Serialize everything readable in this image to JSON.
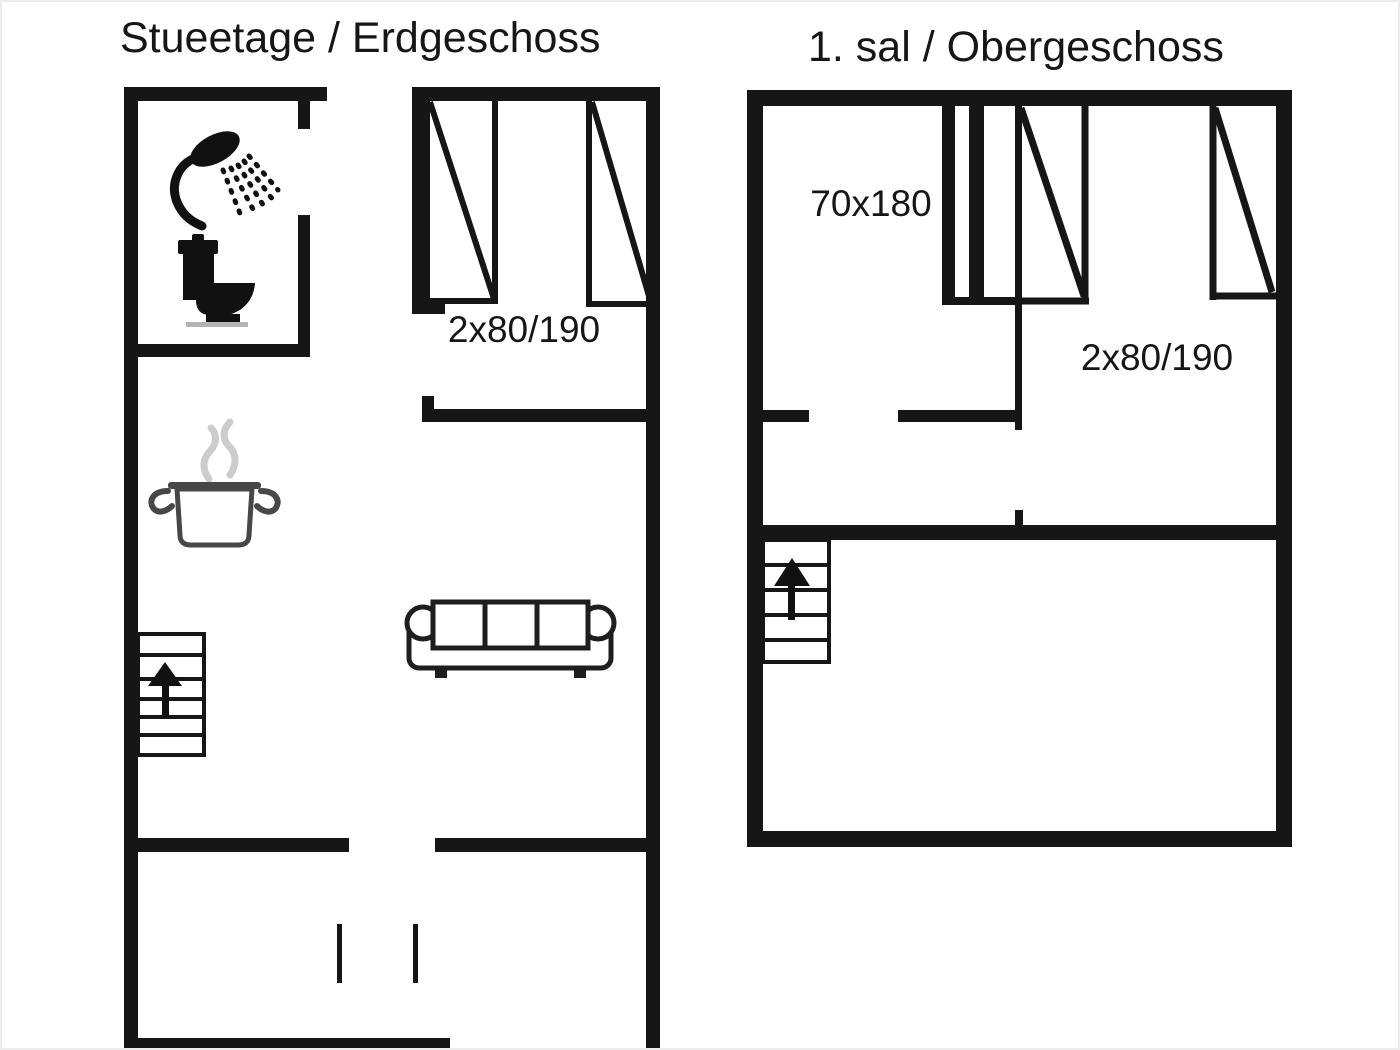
{
  "meta": {
    "background": "#ffffff",
    "wall_color": "#161616",
    "pot_outline_color": "#474747",
    "steam_color": "#cccccc",
    "toilet_base_shadow": "#b5b5b5"
  },
  "ground_floor": {
    "title": "Stueetage / Erdgeschoss",
    "beds_label": "2x80/190",
    "icons": [
      "shower-icon",
      "toilet-icon",
      "cooking-pot-icon",
      "steam-icon",
      "sofa-icon",
      "stairs-up-icon"
    ]
  },
  "upper_floor": {
    "title": "1. sal / Obergeschoss",
    "junior_bed_label": "70x180",
    "beds_label": "2x80/190",
    "icons": [
      "stairs-up-icon"
    ]
  }
}
